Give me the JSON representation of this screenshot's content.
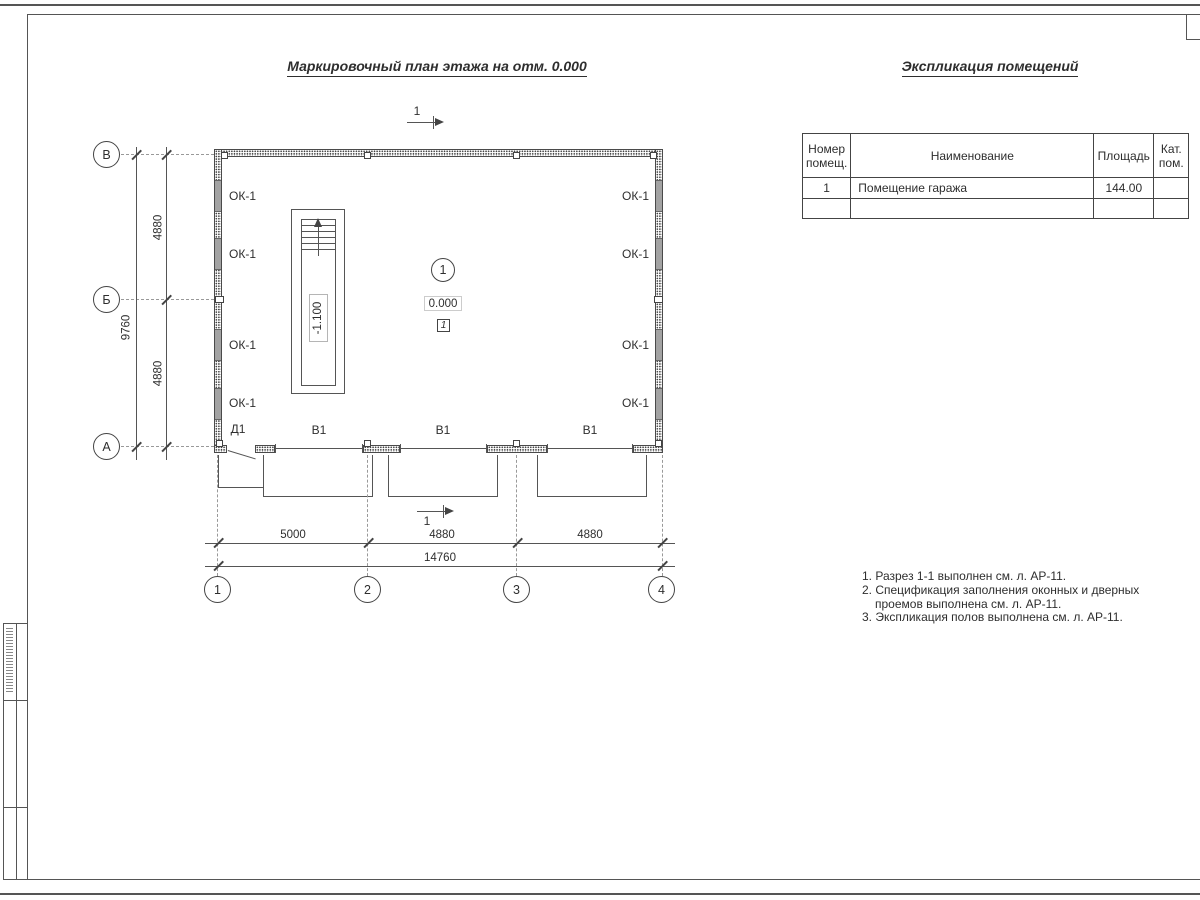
{
  "titles": {
    "plan": "Маркировочный план этажа на отм. 0.000",
    "explication": "Экспликация помещений"
  },
  "explication_table": {
    "headers": {
      "num": "Номер помещ.",
      "name": "Наименование",
      "area": "Площадь",
      "cat": "Кат. пом."
    },
    "rows": [
      {
        "num": "1",
        "name": "Помещение гаража",
        "area": "144.00",
        "cat": ""
      },
      {
        "num": "",
        "name": "",
        "area": "",
        "cat": ""
      }
    ]
  },
  "grid": {
    "row_letters": [
      "В",
      "Б",
      "А"
    ],
    "col_numbers": [
      "1",
      "2",
      "3",
      "4"
    ]
  },
  "dims": {
    "v_segment": "4880",
    "v_total": "9760",
    "h_seg1": "5000",
    "h_seg2": "4880",
    "h_seg3": "4880",
    "h_total": "14760"
  },
  "labels": {
    "window": "ОК-1",
    "door": "Д1",
    "gate": "В1",
    "room_number": "1",
    "zero_elevation": "0.000",
    "floor_type": "1",
    "stair_elevation": "-1.100",
    "section_number": "1"
  },
  "notes": {
    "line1": "1. Разрез 1-1 выполнен см. л. АР-11.",
    "line2": "2. Спецификация заполнения оконных и дверных",
    "line3": "проемов выполнена см. л. АР-11.",
    "line4": "3. Экспликация полов выполнена см. л. АР-11."
  },
  "colors": {
    "line": "#555555",
    "text": "#2e2e2e",
    "window_fill": "#a3a3a3"
  }
}
